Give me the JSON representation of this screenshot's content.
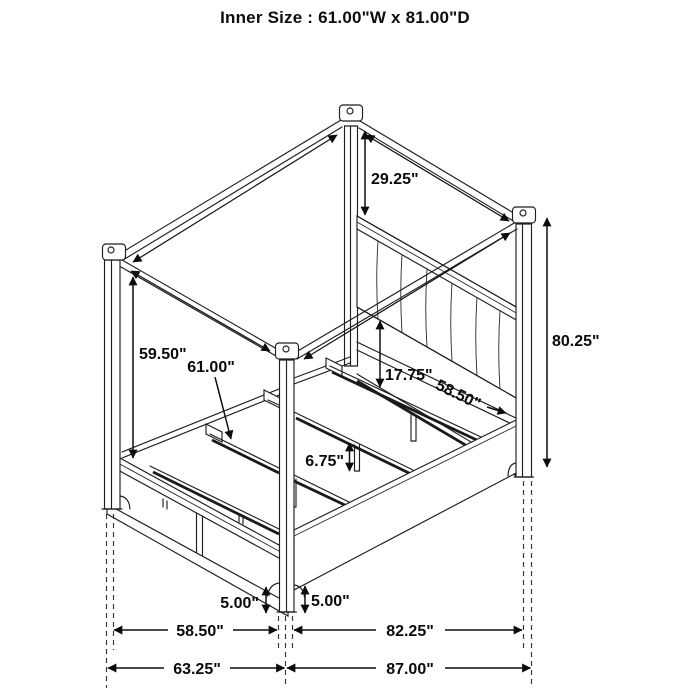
{
  "header": {
    "title": "Inner Size : 61.00\"W x 81.00\"D"
  },
  "diagram": {
    "product": "canopy storage bed line drawing",
    "dims": {
      "post_above_headboard": "29.25\"",
      "overall_height": "80.25\"",
      "canopy_side_height": "59.50\"",
      "slat_rail_width": "61.00\"",
      "headboard_panel_height": "17.75\"",
      "headboard_rail_width": "58.50\"",
      "center_leg_height": "6.75\"",
      "footboard_base_height": "5.00\"",
      "side_rail_base_height": "5.00\"",
      "front_width_inner": "58.50\"",
      "side_depth_inner": "82.25\"",
      "front_width_overall": "63.25\"",
      "side_depth_overall": "87.00\""
    }
  }
}
